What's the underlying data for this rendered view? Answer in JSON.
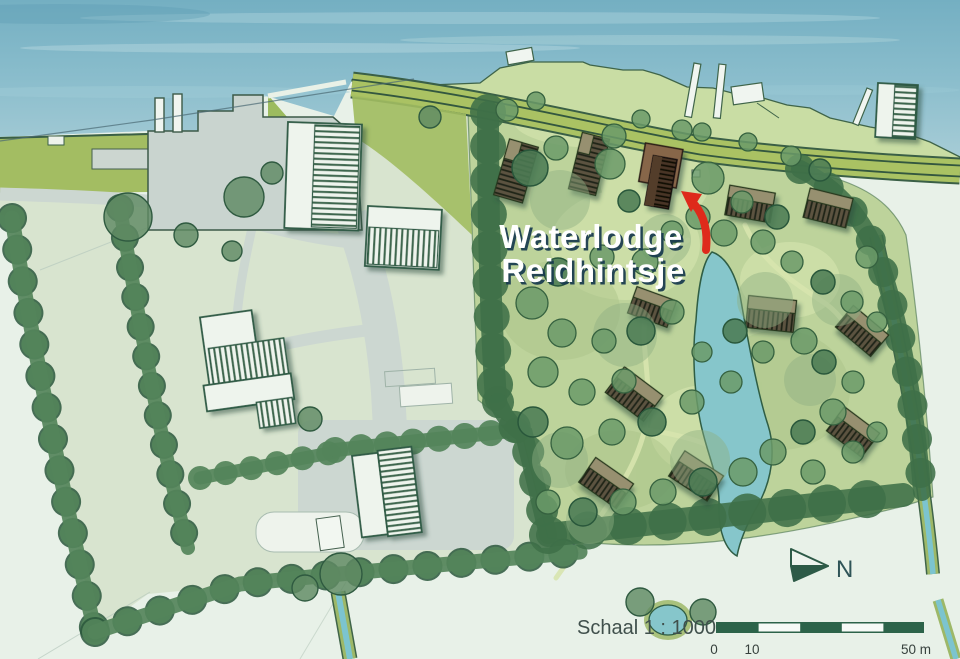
{
  "map": {
    "type": "site-plan",
    "title": {
      "line1": "Waterlodge",
      "line2": "Reidhintsje"
    },
    "north_label": "N",
    "scale": {
      "label": "Schaal 1 : 1000",
      "ticks": [
        "0",
        "10",
        "50 m"
      ]
    },
    "colors": {
      "water": "#7fb5c6",
      "water_light": "#a9cfd9",
      "field": "#e8f1e8",
      "muted_land": "#d8e4cf",
      "park": "#bdd39b",
      "foreshore": "#c9dda4",
      "dike_road": "#aac263",
      "road": "#ccd7d1",
      "tree_dark": "#4c7c54",
      "hedge": "#54845a",
      "pond": "#86c6cb",
      "building_white": "#eef4ed",
      "roof_stripe": "#3c664d",
      "lodge_wall": "#97906f",
      "lodge_roof": "#5c5340",
      "highlight_lodge_front": "#4a3525",
      "highlight_lodge_back": "#87664a",
      "arrow_red": "#de2a1b",
      "scalebar_green": "#2c6349",
      "title_text": "#ffffff",
      "title_shadow": "#17394e"
    }
  }
}
